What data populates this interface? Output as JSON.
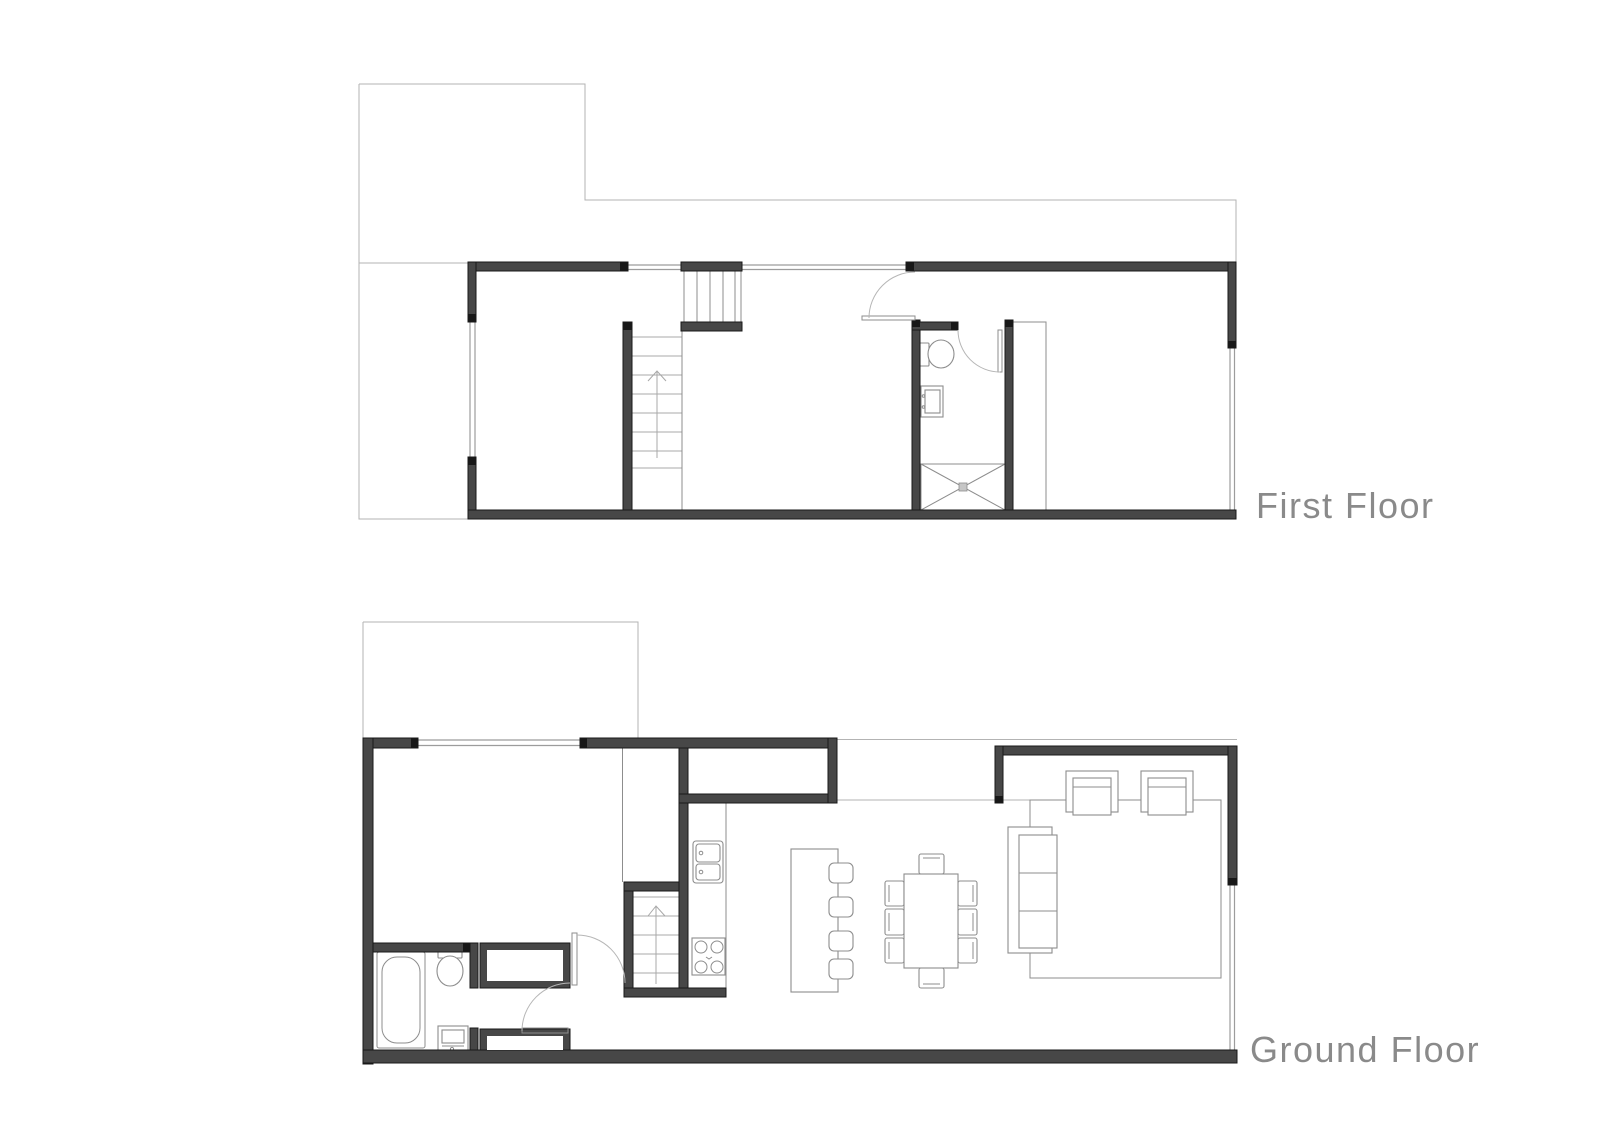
{
  "plans": [
    {
      "id": "first-floor",
      "label": "First Floor"
    },
    {
      "id": "ground-floor",
      "label": "Ground Floor"
    }
  ],
  "style": {
    "background": "#ffffff",
    "wall_fill": "#474747",
    "wall_edge": "#181818",
    "window_line": "#9c9c9c",
    "outline_line": "#b3b3b3",
    "furniture_line": "#8d8d8d",
    "door_arc": "#b6b6b6",
    "tread_line": "#a8a8a8",
    "label_color": "#8a8a8a"
  }
}
